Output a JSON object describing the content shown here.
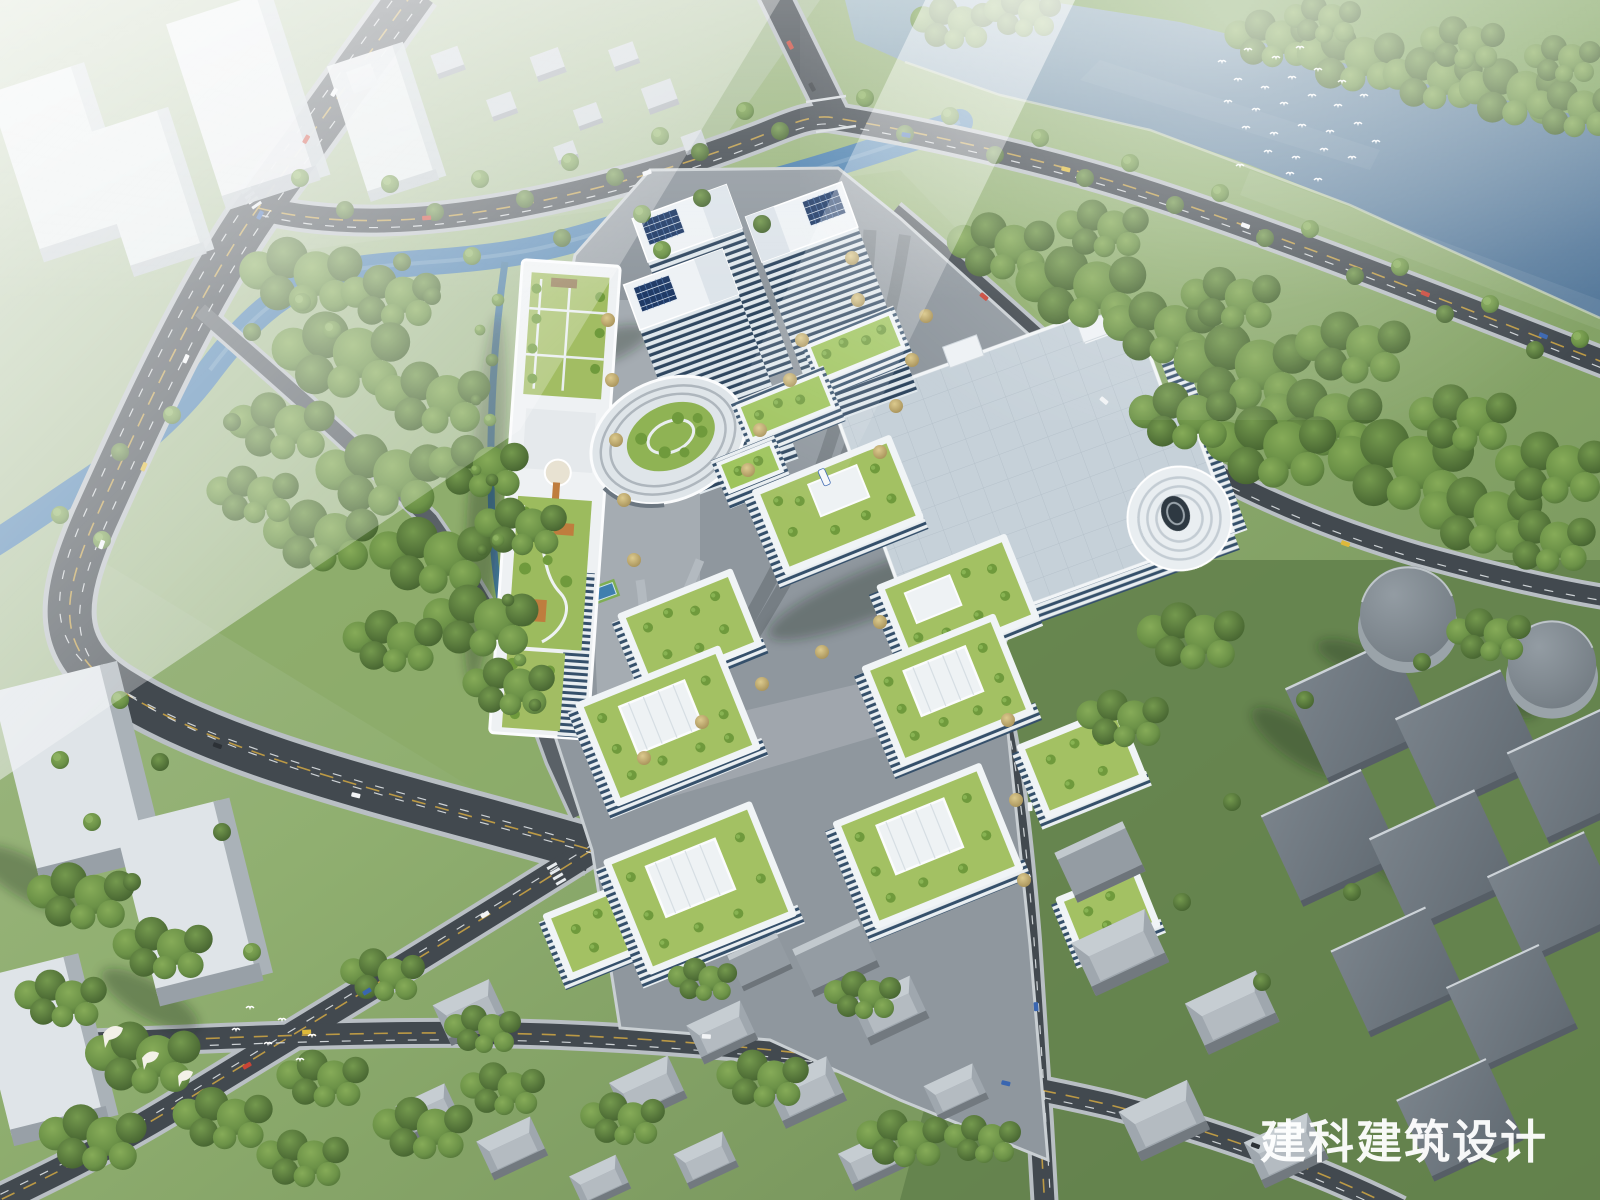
{
  "watermark": {
    "text": "建科建筑设计",
    "color": "#ffffff"
  },
  "palette": {
    "sky_haze": "#ffffff",
    "river_water": "#5d82a2",
    "stream_water": "#4a7fae",
    "grass_light": "#9ab578",
    "grass_dark": "#647f4b",
    "forest_green": "#5f8443",
    "tree_autumn": "#c9b97c",
    "road_major": "#42494f",
    "road_minor": "#5a6167",
    "sidewalk": "#b9bfc4",
    "lane_yellow": "#c9a244",
    "lane_white": "#e8ecef",
    "building_white": "#eef2f5",
    "glass_curtainwall": "#32475e",
    "solar_panel": "#1f3a66",
    "green_roof": "#a3c163",
    "roof_tree": "#6f9a3c",
    "exhibition_roof": "#c6d1d9",
    "warehouse_roof": "#6e7880",
    "tank_top": "#848d94",
    "campus_paving": "#8f979e",
    "deck_wood": "#bf7d3e",
    "sport_court": "#3f7fae",
    "bird_white": "#ffffff"
  },
  "vehicle_colors": [
    "#f2f4f6",
    "#c94436",
    "#3a66b0",
    "#ddb93b",
    "#2c3136"
  ]
}
